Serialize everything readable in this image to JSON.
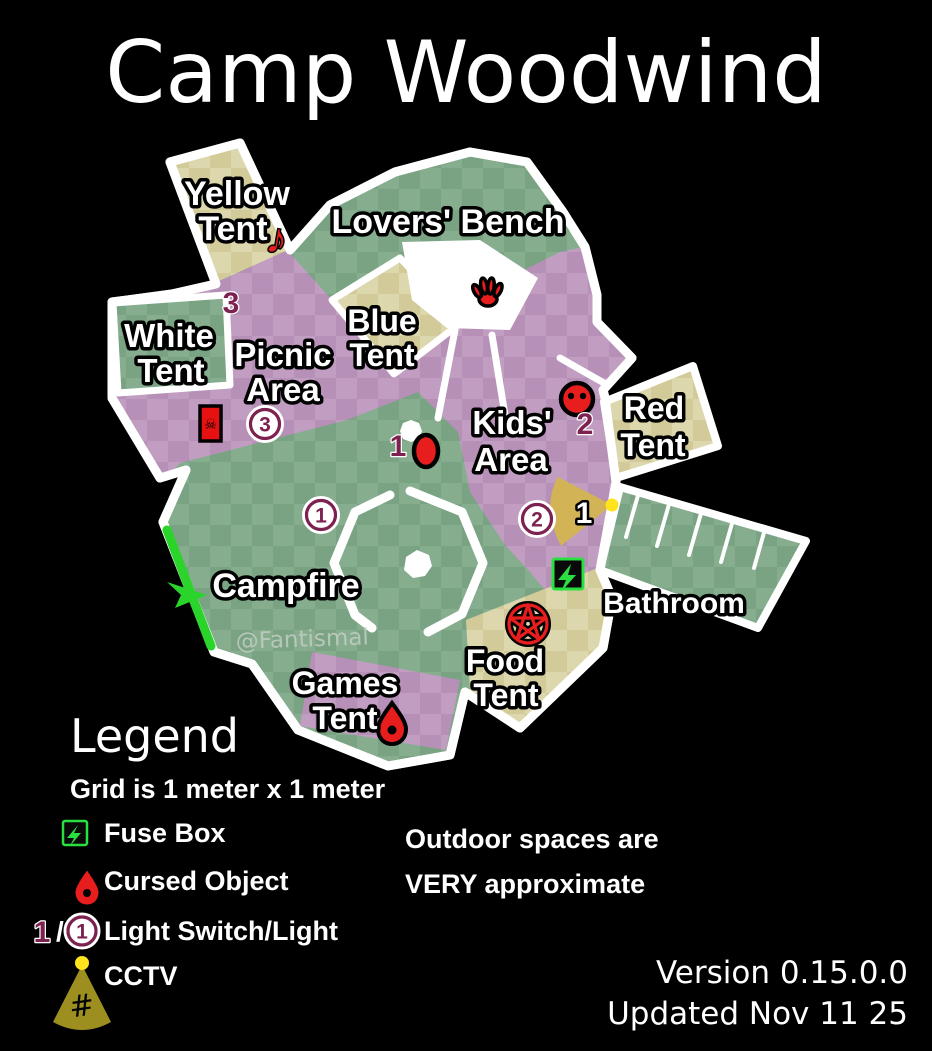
{
  "title": "Camp Woodwind",
  "watermark": "@Fantismal",
  "map": {
    "labels": {
      "yellow_tent": [
        "Yellow",
        "Tent"
      ],
      "lovers_bench": "Lovers' Bench",
      "white_tent": [
        "White",
        "Tent"
      ],
      "picnic_area": [
        "Picnic",
        "Area"
      ],
      "blue_tent": [
        "Blue",
        "Tent"
      ],
      "kids_area": [
        "Kids'",
        "Area"
      ],
      "red_tent": [
        "Red",
        "Tent"
      ],
      "campfire": "Campfire",
      "bathroom": "Bathroom",
      "food_tent": [
        "Food",
        "Tent"
      ],
      "games_tent": [
        "Games",
        "Tent"
      ]
    },
    "markers": {
      "switches": {
        "picnic": "3",
        "campfire": "1",
        "kids": "2"
      },
      "lights": {
        "picnic": "3",
        "campfire": "1",
        "kids": "2"
      },
      "cctv": {
        "bathroom": "1"
      }
    },
    "icons": {
      "music_note": "♪",
      "skull": "☠"
    }
  },
  "legend": {
    "heading": "Legend",
    "grid_note": "Grid is 1 meter x 1 meter",
    "fuse_box": "Fuse Box",
    "cursed_object": "Cursed Object",
    "light_switch_number": "1",
    "light_switch_slash": "/",
    "light_number": "1",
    "light_switch_label": "Light Switch/Light",
    "cctv_label": "CCTV",
    "cctv_hash": "#",
    "note_line1": "Outdoor spaces are",
    "note_line2": "VERY approximate"
  },
  "footer": {
    "version": "Version 0.15.0.0",
    "updated": "Updated Nov 11 25"
  },
  "colors": {
    "background": "#000000",
    "outline_white": "#ffffff",
    "green_dark": "#7aa384",
    "green_light": "#86ad8e",
    "purple_dark": "#b690b7",
    "purple_light": "#c09dc1",
    "tan_dark": "#d2cb99",
    "tan_light": "#ddd7ad",
    "entrance_green": "#2bd42b",
    "cursed_red": "#e81e1e",
    "marker_maroon": "#7d2150",
    "fuse_green": "#2ae040",
    "cctv_cone_map": "#d2b456",
    "cctv_cone_legend": "#9c8f1f",
    "cctv_dot_yellow": "#ffe31c"
  }
}
